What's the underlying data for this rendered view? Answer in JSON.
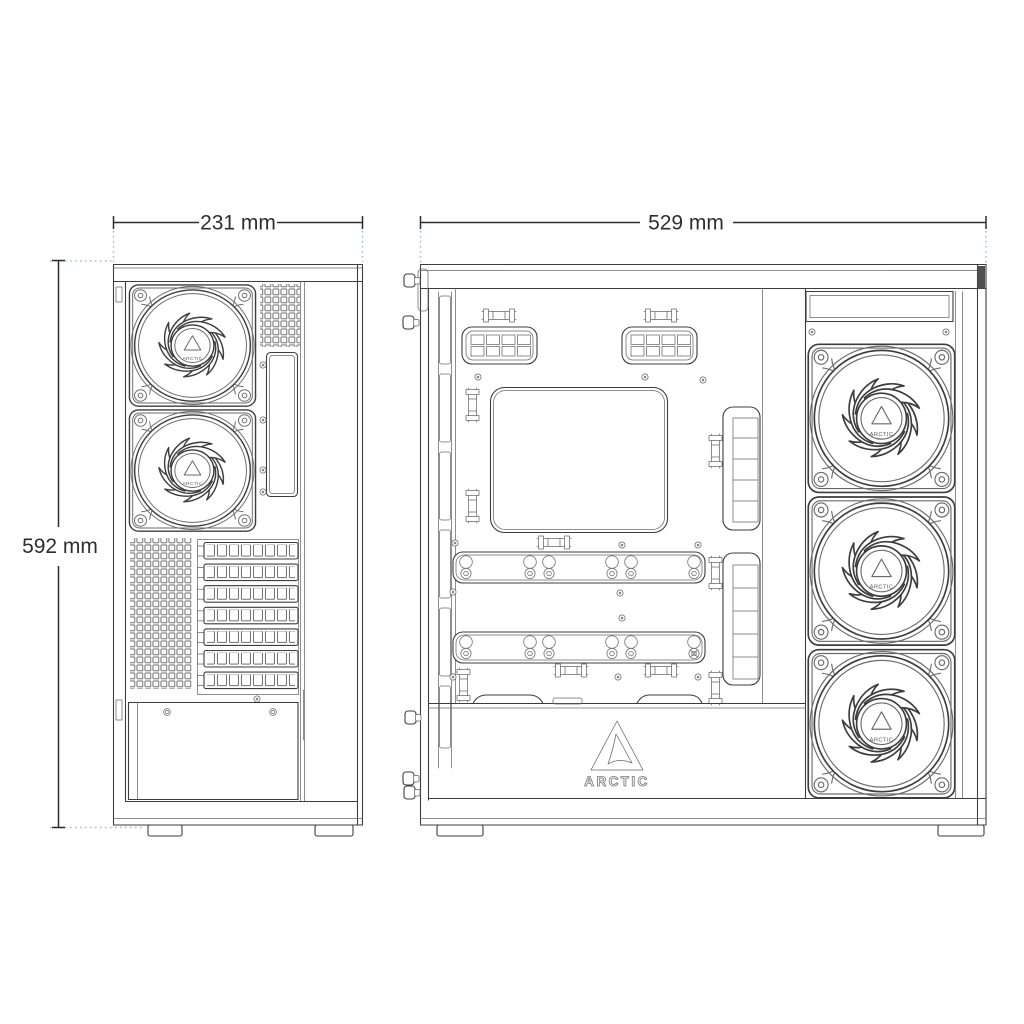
{
  "dimensions": {
    "width": {
      "label": "231 mm",
      "value_mm": 231
    },
    "depth": {
      "label": "529 mm",
      "value_mm": 529
    },
    "height": {
      "label": "592 mm",
      "value_mm": 592
    }
  },
  "brand": {
    "fan_hub_label": "ARCTIC",
    "shroud_logo_label": "ARCTIC"
  },
  "colors": {
    "background": "#ffffff",
    "line": "#3d3d3d",
    "thin_line": "#6a6a6a",
    "dimension_line": "#2e2e2e",
    "extension_dots": "#9fc0c0",
    "corner_shade": "#4f4f4f",
    "logo_outline": "#7a7a7a"
  }
}
